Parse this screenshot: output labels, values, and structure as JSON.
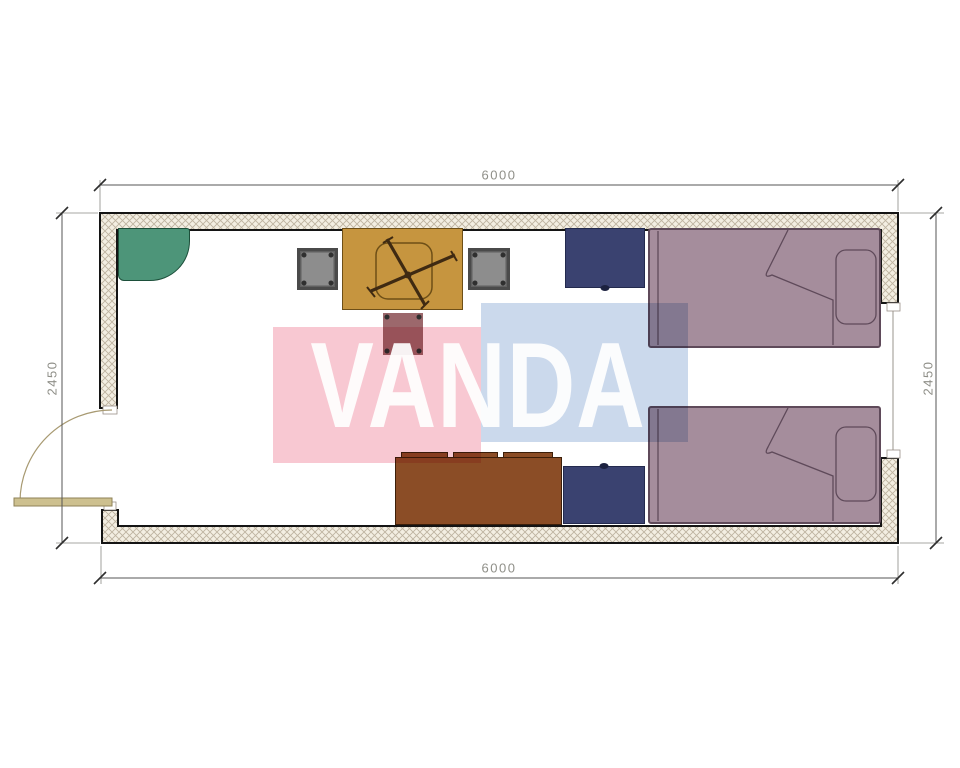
{
  "watermark": {
    "text": "VANDA"
  },
  "dimensions": {
    "top": "6000",
    "bottom": "6000",
    "left": "2450",
    "right": "2450"
  },
  "colors": {
    "wall_fill": "#f3eee2",
    "wall_hatch": "#beb3a0",
    "wall_line": "#141414",
    "shelf": "#4d9579",
    "shelf_line": "#1c4f3a",
    "desk": "#c6953f",
    "desk_line": "#6e4f17",
    "deskchair_line": "#3f2a12",
    "chair": "#8d8d8d",
    "chair_frame": "#4a4a4a",
    "stool": "#9c686c",
    "nightstand": "#3a4270",
    "nightstand_line": "#232a4e",
    "bed": "#a58d9c",
    "bed_line": "#5f4a5a",
    "sofa": "#8b4d26",
    "sofa_line": "#3c1f0a",
    "door": "#cdc08f",
    "door_line": "#8f8257",
    "arc_line": "#a89a72",
    "dim_line": "#555555",
    "dim_text": "#8f8f88",
    "watermark_pink": "#f8c8d2",
    "watermark_blue": "#cbd9ec",
    "watermark_text": "#ffffff"
  }
}
